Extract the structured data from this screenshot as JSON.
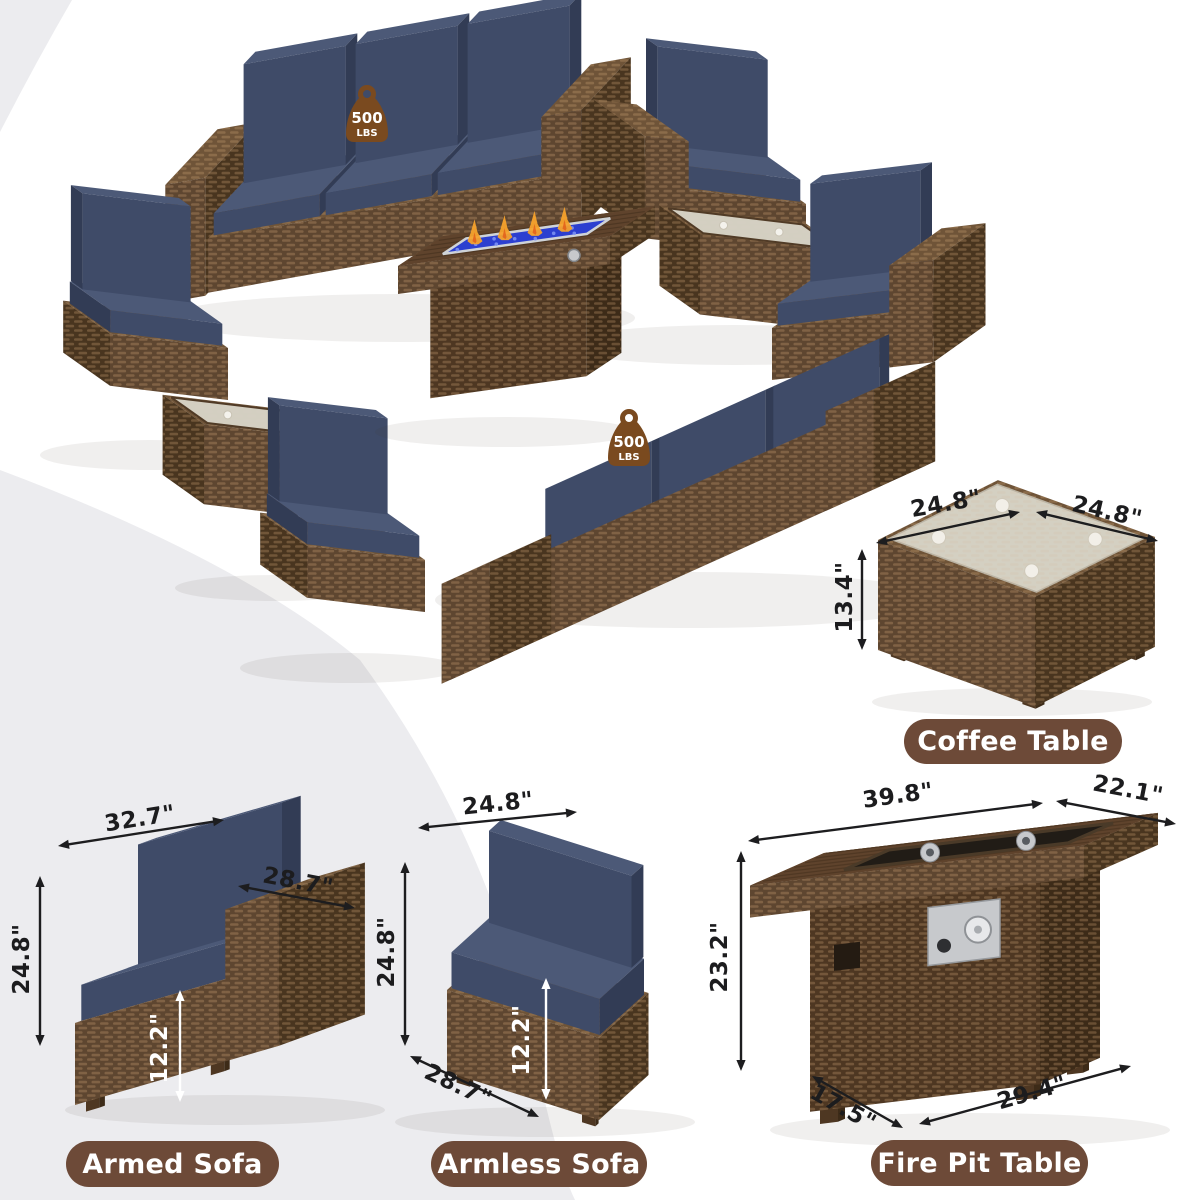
{
  "badge": {
    "top": "500",
    "bottom": "LBS"
  },
  "products": [
    {
      "label": "Coffee Table",
      "dims": {
        "top_left": "24.8\"",
        "top_right": "24.8\"",
        "height": "13.4\""
      }
    },
    {
      "label": "Armed Sofa",
      "dims": {
        "width": "32.7\"",
        "arm_depth": "28.7\"",
        "height": "24.8\"",
        "seat_height": "12.2\""
      }
    },
    {
      "label": "Armless Sofa",
      "dims": {
        "width": "24.8\"",
        "height": "24.8\"",
        "seat_height": "12.2\"",
        "depth": "28.7\""
      }
    },
    {
      "label": "Fire Pit Table",
      "dims": {
        "top_width": "39.8\"",
        "top_depth": "22.1\"",
        "height": "23.2\"",
        "base_depth": "17.5\"",
        "base_width": "29.4\""
      }
    }
  ],
  "colors": {
    "background": "#ffffff",
    "band": "#ececef",
    "wicker_front": "#5e4630",
    "wicker_side": "#49351f",
    "wicker_top": "#6f5438",
    "wicker_dark_front": "#4e3722",
    "wicker_dark_side": "#3d2b18",
    "wicker_dark_top": "#5b4129",
    "weave": "#cda373",
    "cushion_front": "#3f4b68",
    "cushion_side": "#323c55",
    "cushion_top": "#4c5977",
    "glass": "#d8d4c7",
    "glass_rim": "#4f3a26",
    "wood_top": "#5f432c",
    "wood_line": "#4b3521",
    "fire_glass": "#2c3fd0",
    "fire_speckle": "#7b90f2",
    "flame": "#f6a22c",
    "flame_deep": "#e2631c",
    "metal": "#c7c9cc",
    "metal_dark": "#585c61",
    "inset_dark": "#211c16",
    "arrow": "#1d1d1f",
    "arrow_white": "#ffffff",
    "badge": "#7a4a1f",
    "pill": "#6d4a38",
    "text_white": "#ffffff",
    "dim_text": "#1c1c1e"
  }
}
